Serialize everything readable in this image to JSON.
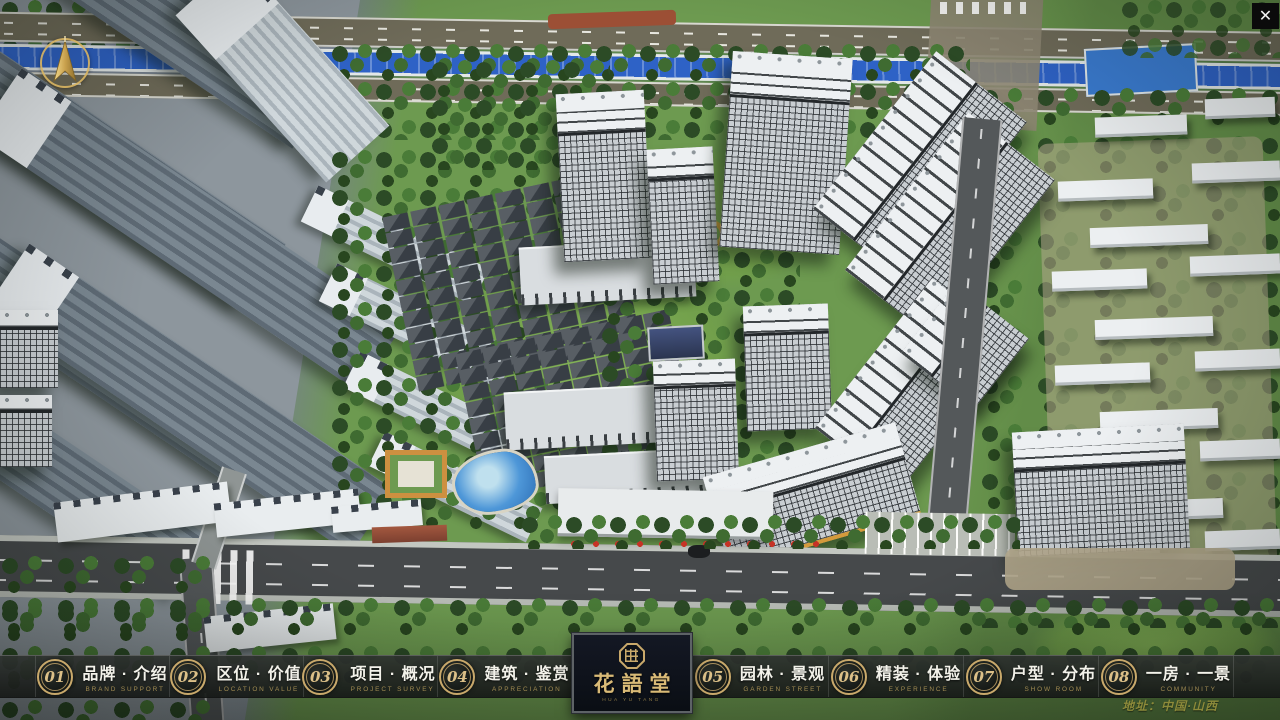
{
  "navbar": {
    "items": [
      {
        "num": "01",
        "zh": "品牌 · 介绍",
        "en": "BRAND SUPPORT"
      },
      {
        "num": "02",
        "zh": "区位 · 价值",
        "en": "LOCATION VALUE"
      },
      {
        "num": "03",
        "zh": "项目 · 概况",
        "en": "PROJECT SURVEY"
      },
      {
        "num": "04",
        "zh": "建筑 · 鉴赏",
        "en": "APPRECIATION"
      },
      {
        "num": "05",
        "zh": "园林 · 景观",
        "en": "GARDEN STREET"
      },
      {
        "num": "06",
        "zh": "精装 · 体验",
        "en": "EXPERIENCE"
      },
      {
        "num": "07",
        "zh": "户型 · 分布",
        "en": "SHOW ROOM"
      },
      {
        "num": "08",
        "zh": "一房 · 一景",
        "en": "COMMUNITY"
      }
    ]
  },
  "logo": {
    "title": "花語堂",
    "subtitle": "HUA YU TANG"
  },
  "footer": {
    "address": "地址：中国·山西"
  },
  "window": {
    "close_glyph": "✕"
  },
  "colors": {
    "accent_gold": "#C9A96B",
    "bar_background": "#1B1F1D",
    "logo_background": "#0D1118",
    "river_blue": "#2E62C6"
  }
}
